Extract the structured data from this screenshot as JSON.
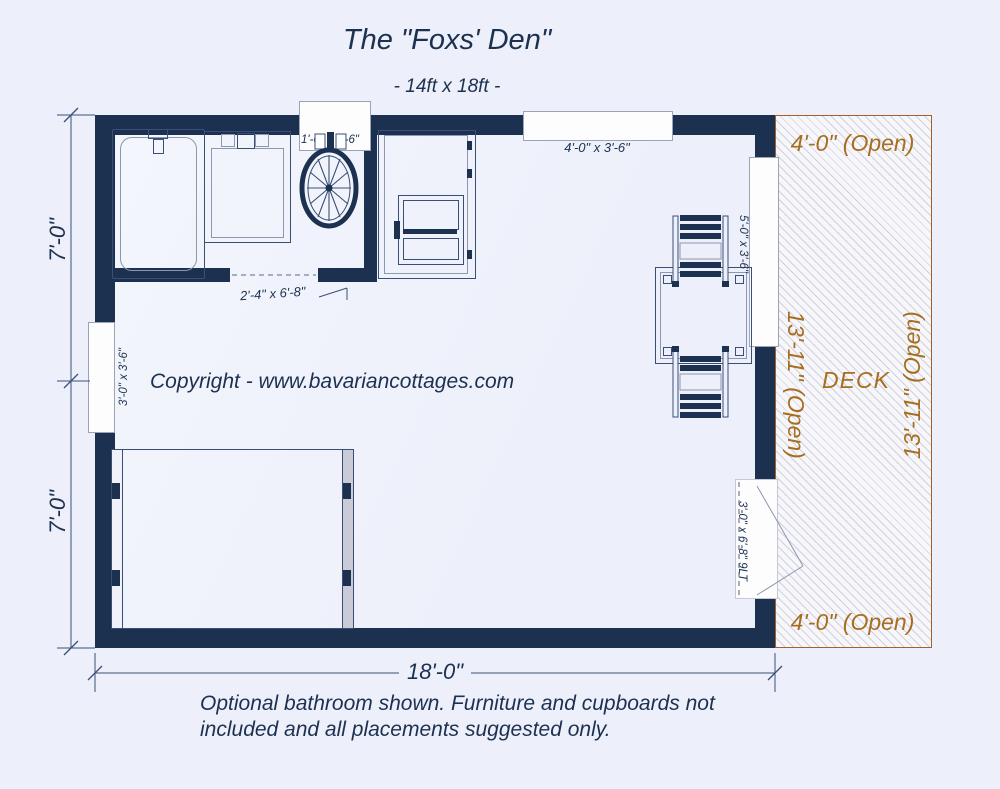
{
  "title": "The \"Foxs' Den\"",
  "subtitle": "- 14ft x 18ft -",
  "copyright": "Copyright - www.bavariancottages.com",
  "note": {
    "line1": "Optional bathroom shown. Furniture and cupboards not",
    "line2": "included and all placements suggested only."
  },
  "dimensions": {
    "left_upper": "7'-0\"",
    "left_lower": "7'-0\"",
    "bottom": "18'-0\""
  },
  "openings": {
    "bath_window": "1'-6\" x 2'-6\"",
    "front_window": "4'-0\" x 3'-6\"",
    "left_window": "3'-0\" x 3'-6\"",
    "right_window": "5'-0\" x 3'-6\"",
    "bath_door": "2'-4\" x 6'-8\"",
    "deck_door": "3'-0\" x 6'-8\" 9LT"
  },
  "deck": {
    "label": "DECK",
    "top_dim": "4'-0\" (Open)",
    "bottom_dim": "4'-0\" (Open)",
    "left_dim": "13'-11\" (Open)",
    "right_dim": "13'-11\" (Open)"
  },
  "colors": {
    "wall": "#1c3150",
    "background": "#edeffa",
    "deck_text": "#a86e20",
    "deck_border": "#a5602c"
  }
}
